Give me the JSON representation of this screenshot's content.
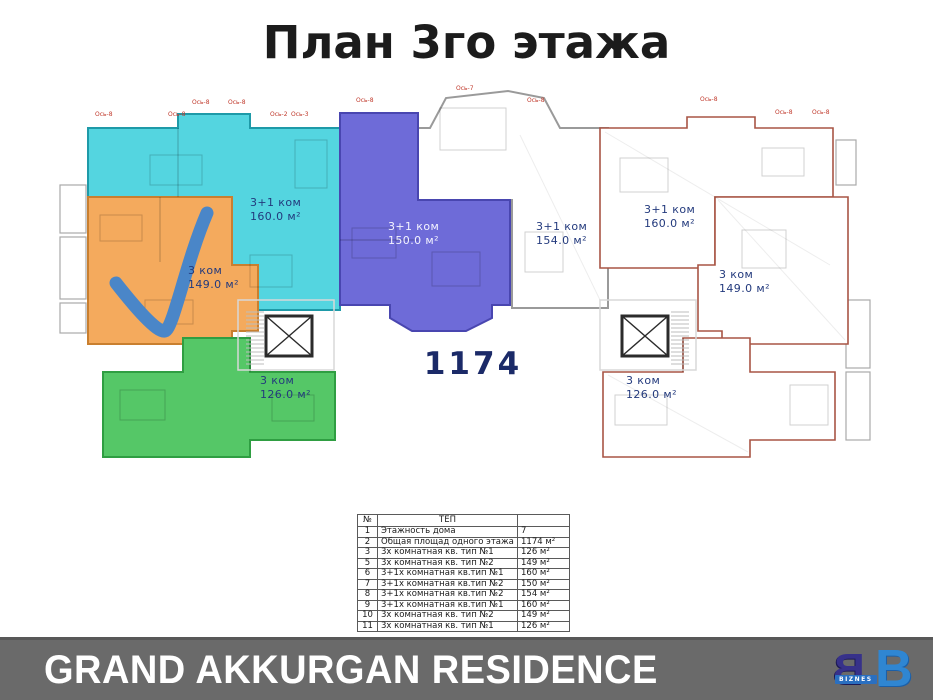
{
  "page": {
    "title": "План 3го этажа",
    "background": "#ffffff"
  },
  "plan": {
    "total_area_label": "1174",
    "total_area_color": "#1b2a68",
    "outline_color": "#a85545",
    "wall_color": "#9a9a9a",
    "checkmark_color": "#4a86c8",
    "label_color": "#233a7d",
    "axis": [
      "Ось-8",
      "Ось-8",
      "Ось-8",
      "Ось-8",
      "Ось-2",
      "Ось-3",
      "Ось-8",
      "Ось-7",
      "Ось-8",
      "Ось-8",
      "Ось-8",
      "Ось-8"
    ],
    "apartments": [
      {
        "name": "left-top",
        "type": "3+1 ком",
        "area": "160.0 м²",
        "fill": "#54d5e0",
        "selected": false
      },
      {
        "name": "left-middle",
        "type": "3 ком",
        "area": "149.0 м²",
        "fill": "#f4aa5d",
        "selected": true
      },
      {
        "name": "left-bottom",
        "type": "3 ком",
        "area": "126.0 м²",
        "fill": "#55c767",
        "selected": false
      },
      {
        "name": "center",
        "type": "3+1 ком",
        "area": "150.0 м²",
        "fill": "#6e6bd8",
        "selected": false
      },
      {
        "name": "center-right",
        "type": "3+1 ком",
        "area": "154.0 м²",
        "fill": "#ffffff",
        "selected": false
      },
      {
        "name": "right-top",
        "type": "3+1 ком",
        "area": "160.0 м²",
        "fill": "#ffffff",
        "selected": false
      },
      {
        "name": "right-middle",
        "type": "3 ком",
        "area": "149.0 м²",
        "fill": "#ffffff",
        "selected": false
      },
      {
        "name": "right-bottom",
        "type": "3 ком",
        "area": "126.0 м²",
        "fill": "#ffffff",
        "selected": false
      }
    ]
  },
  "table": {
    "headers": [
      "№",
      "ТЕП",
      ""
    ],
    "rows": [
      [
        "1",
        "Этажность дома",
        "7"
      ],
      [
        "2",
        "Общая площад одного этажа",
        "1174 м²"
      ],
      [
        "3",
        "3х комнатная кв. тип №1",
        "126 м²"
      ],
      [
        "5",
        "3х комнатная кв. тип №2",
        "149 м²"
      ],
      [
        "6",
        "3+1х комнатная кв.тип №1",
        "160 м²"
      ],
      [
        "7",
        "3+1х комнатная кв.тип №2",
        "150 м²"
      ],
      [
        "8",
        "3+1х комнатная кв.тип №2",
        "154 м²"
      ],
      [
        "9",
        "3+1х комнатная кв.тип №1",
        "160 м²"
      ],
      [
        "10",
        "3х комнатная кв. тип №2",
        "149 м²"
      ],
      [
        "11",
        "3х комнатная кв. тип №1",
        "126 м²"
      ]
    ]
  },
  "footer": {
    "brand": "GRAND AKKURGAN RESIDENCE",
    "bar_color": "#6a6a6a",
    "text_color": "#ffffff",
    "logo_letters": [
      "B",
      "B"
    ],
    "logo_text": "BIZNES"
  }
}
